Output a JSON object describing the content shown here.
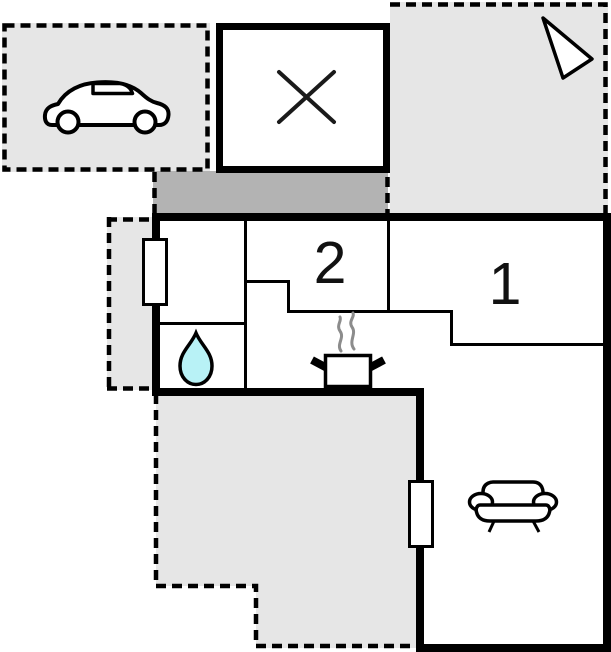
{
  "plan_title": "floor-plan",
  "rooms": {
    "room1": {
      "label": "1"
    },
    "room2": {
      "label": "2"
    }
  },
  "icons": {
    "car": "car-icon",
    "north_arrow": "north-arrow-icon",
    "crossed_room": "x-mark-icon",
    "water_drop": "water-drop-icon",
    "stove_pot": "stove-pot-icon",
    "steam": "steam-icon",
    "sofa": "sofa-icon",
    "window": "window-marker"
  },
  "colors": {
    "area_fill": "#e6e6e6",
    "entry_fill": "#b3b3b3",
    "wall": "#000000",
    "room_fill": "#ffffff",
    "water_fill": "#b8f2f6",
    "steam": "#8c8c8c"
  }
}
